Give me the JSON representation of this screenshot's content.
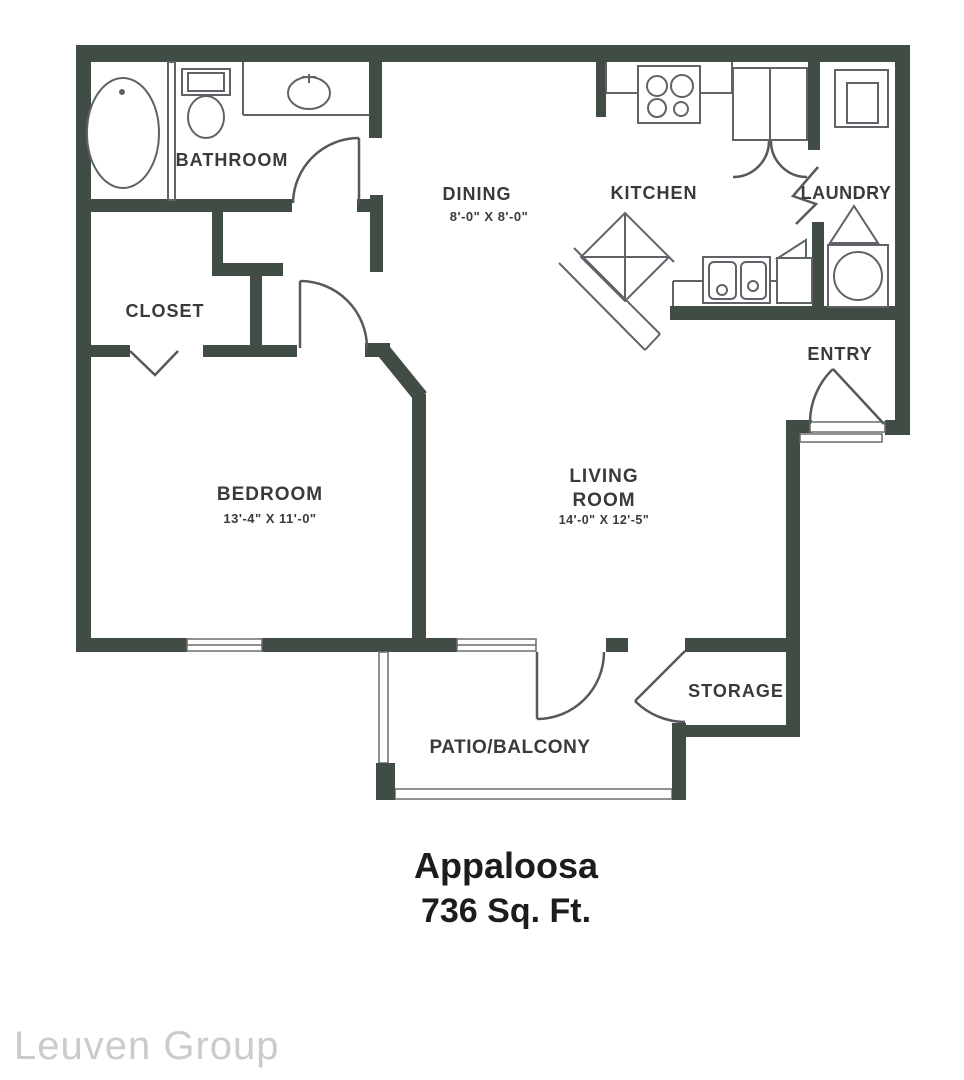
{
  "plan": {
    "title": "Appaloosa",
    "area_label": "736 Sq. Ft.",
    "watermark": "Leuven Group",
    "rooms": {
      "bathroom": {
        "label": "BATHROOM"
      },
      "closet": {
        "label": "CLOSET"
      },
      "bedroom": {
        "label": "BEDROOM",
        "dimensions": "13'-4\" X 11'-0\""
      },
      "dining": {
        "label": "DINING",
        "dimensions": "8'-0\" X 8'-0\""
      },
      "kitchen": {
        "label": "KITCHEN"
      },
      "laundry": {
        "label": "LAUNDRY"
      },
      "entry": {
        "label": "ENTRY"
      },
      "living_room": {
        "label_line1": "LIVING",
        "label_line2": "ROOM",
        "dimensions": "14'-0\" X 12'-5\""
      },
      "storage": {
        "label": "STORAGE"
      },
      "patio": {
        "label": "PATIO/BALCONY"
      }
    },
    "colors": {
      "wall": "#414c45",
      "fixture_line": "#5f6368",
      "label_text": "#3a3a3a",
      "title_text": "#1c1c1c",
      "watermark_text": "#cbcbcb",
      "background": "#ffffff"
    }
  }
}
